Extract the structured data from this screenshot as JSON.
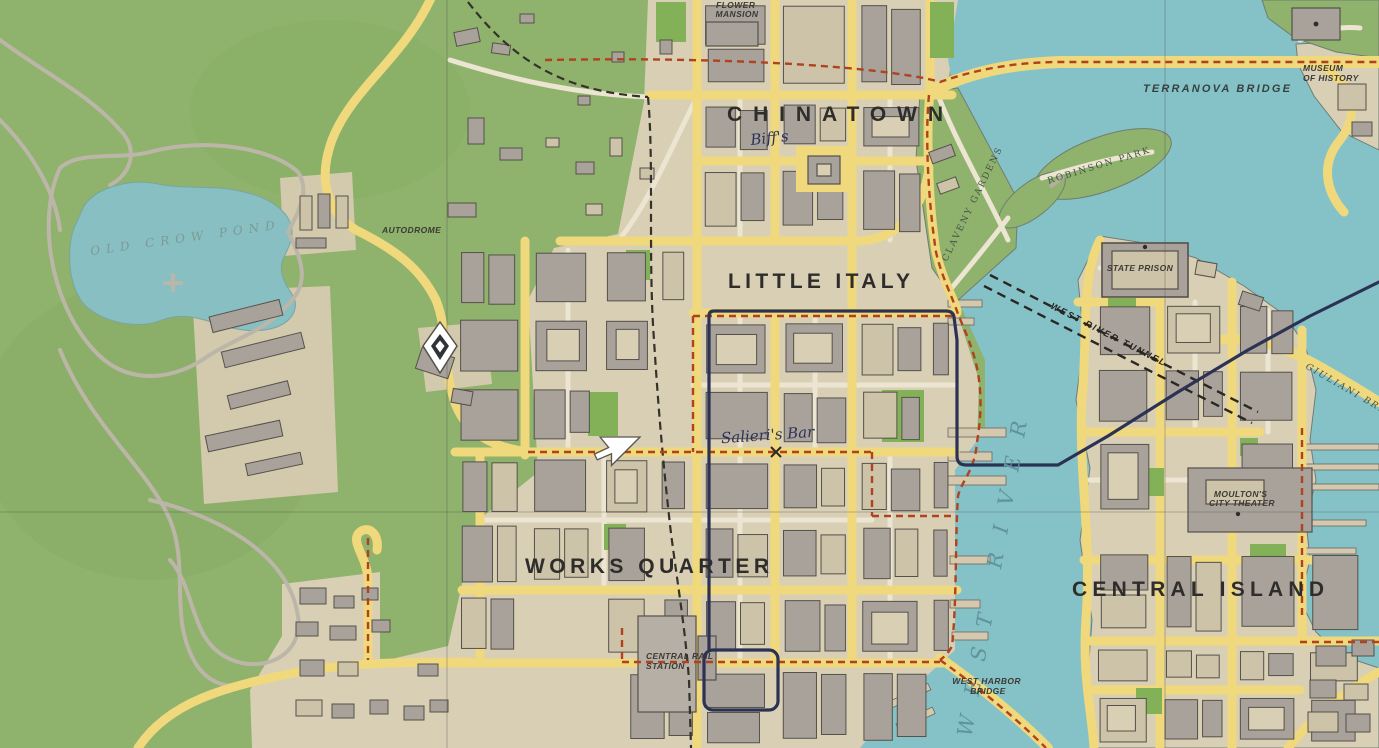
{
  "labels": {
    "districts": {
      "chinatown": "CHINATOWN",
      "little_italy": "LITTLE ITALY",
      "works_quarter": "WORKS QUARTER",
      "central_island": "CENTRAL ISLAND"
    },
    "water": {
      "west_river": "WEST RIVER",
      "old_crow_pond": "OLD CROW POND"
    },
    "bridges": {
      "terranova": "TERRANOVA BRIDGE",
      "giuliani": "GIULIANI BRIDGE",
      "west_harbor_1": "WEST HARBOR",
      "west_harbor_2": "BRIDGE",
      "tunnel": "WEST RIVER TUNNEL"
    },
    "places": {
      "flower_mansion_1": "FLOWER",
      "flower_mansion_2": "MANSION",
      "museum_1": "MUSEUM",
      "museum_2": "OF HISTORY",
      "robinson_park": "ROBINSON PARK",
      "claveny_gardens": "CLAVENY GARDENS",
      "state_prison": "STATE PRISON",
      "autodrome": "AUTODROME",
      "central_rail_1": "CENTRAL RAIL",
      "central_rail_2": "STATION",
      "theater_1": "MOULTON'S",
      "theater_2": "CITY THEATER"
    },
    "pois": {
      "biffs": "Biff's",
      "salieris_bar": "Salieri's Bar"
    }
  },
  "markers": {
    "waypoint": "diamond-waypoint",
    "destination": "x-mark",
    "cursor": "white-pointer"
  },
  "colors": {
    "park_green": "#8fb26c",
    "bright_green": "#82b158",
    "urban_tan": "#d9cfb5",
    "building_gray": "#a8a29b",
    "building_light": "#cdc3a9",
    "road_yellow": "#f0d87c",
    "minor_road": "#ece5d2",
    "water_teal": "#85c2c7",
    "boundary_red": "#b0421e",
    "route_navy": "#2b3254",
    "label_dark": "#2e2d2b"
  }
}
